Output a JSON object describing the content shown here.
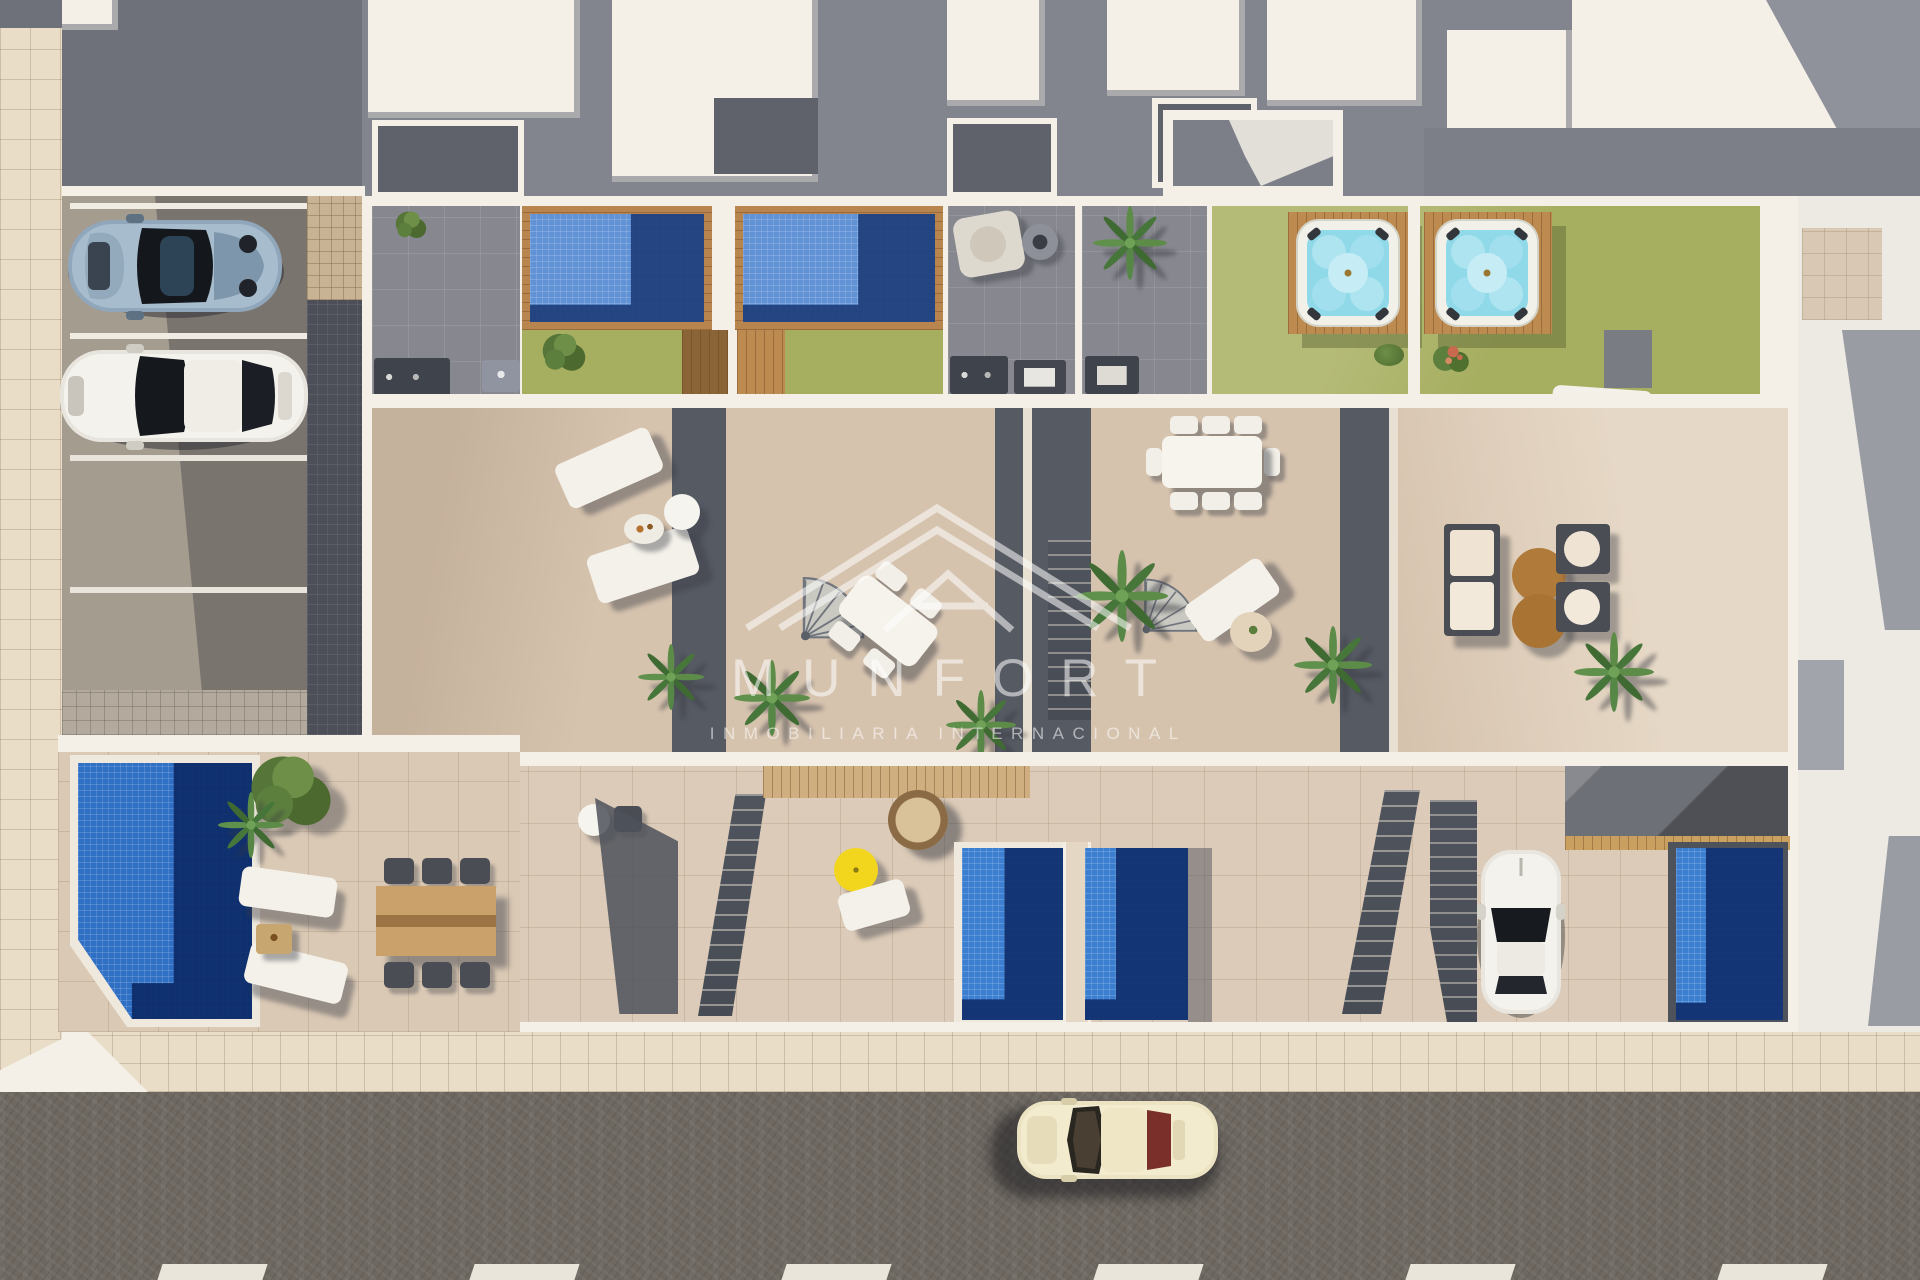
{
  "watermark": {
    "brand": "MUNFORT",
    "tagline": "INMOBILIARIA INTERNACIONAL",
    "logo": "nested-triangle-mountain-logo"
  },
  "palette": {
    "wallWhite": "#f4f0e7",
    "terrace": "#d6c3ae",
    "terraceLight": "#e4d4c1",
    "grayPatio": "#87888f",
    "darkStrip": "#565a63",
    "lawn": "#a6ae60",
    "lawnShade": "#8a9550",
    "poolFrameWood": "#b9854e",
    "deckWood": "#bd8a50",
    "poolMosaicLight": "#6292d6",
    "poolMosaicDark": "#1d3c78",
    "groundPoolLight": "#3c7fd0",
    "groundPoolDark": "#102e6d",
    "gardenPoolLight": "#2f6fc4",
    "gardenPoolDark": "#0d2a66",
    "jacuzziWater": "#8fd9e9",
    "umbrellaYellow": "#f2d51d",
    "coffeeBrown": "#b07a3a",
    "road": "#6e6861",
    "laneMark": "#e9e5da",
    "sidewalk": "#e9ddc7",
    "parkingLight": "#a59c90",
    "parkingDark": "#7a746e",
    "pavingDark": "#4c4f57",
    "neighborGray": "#82848e",
    "neighborDark": "#5f616b",
    "wmOpacity": "0.55"
  },
  "scene": {
    "description": "Aerial top-down 3D render of a row of four townhouses with rooftop pools, jacuzzis, lawns and terraces, street-level patios and pools, side parking with two cars, a sidewalk and an asphalt street with a driving car.",
    "objects": [
      {
        "name": "neighboring-roof-blocks",
        "count": 7
      },
      {
        "name": "parked-sports-car",
        "color": "blue-gray"
      },
      {
        "name": "parked-sedan",
        "color": "white"
      },
      {
        "name": "rooftop-pool",
        "count": 2
      },
      {
        "name": "jacuzzi-on-deck",
        "count": 2
      },
      {
        "name": "rooftop-lawn",
        "count": 4
      },
      {
        "name": "bbq-counter",
        "count": 3
      },
      {
        "name": "sun-lounger",
        "count": 8
      },
      {
        "name": "outdoor-dining-set",
        "count": 3
      },
      {
        "name": "sofa-lounge-set",
        "count": 1
      },
      {
        "name": "round-coffee-table",
        "count": 2
      },
      {
        "name": "spiral-staircase",
        "count": 2
      },
      {
        "name": "palm-tree",
        "count": 7
      },
      {
        "name": "garden-tree",
        "count": 2
      },
      {
        "name": "rose-bush",
        "count": 1
      },
      {
        "name": "ground-pool",
        "count": 4
      },
      {
        "name": "yellow-parasol",
        "count": 1
      },
      {
        "name": "hanging-egg-chair",
        "count": 1
      },
      {
        "name": "driveway-car",
        "color": "white"
      },
      {
        "name": "street-car",
        "color": "cream"
      },
      {
        "name": "lane-markings",
        "count": 6
      },
      {
        "name": "sidewalk",
        "count": 2
      }
    ]
  }
}
